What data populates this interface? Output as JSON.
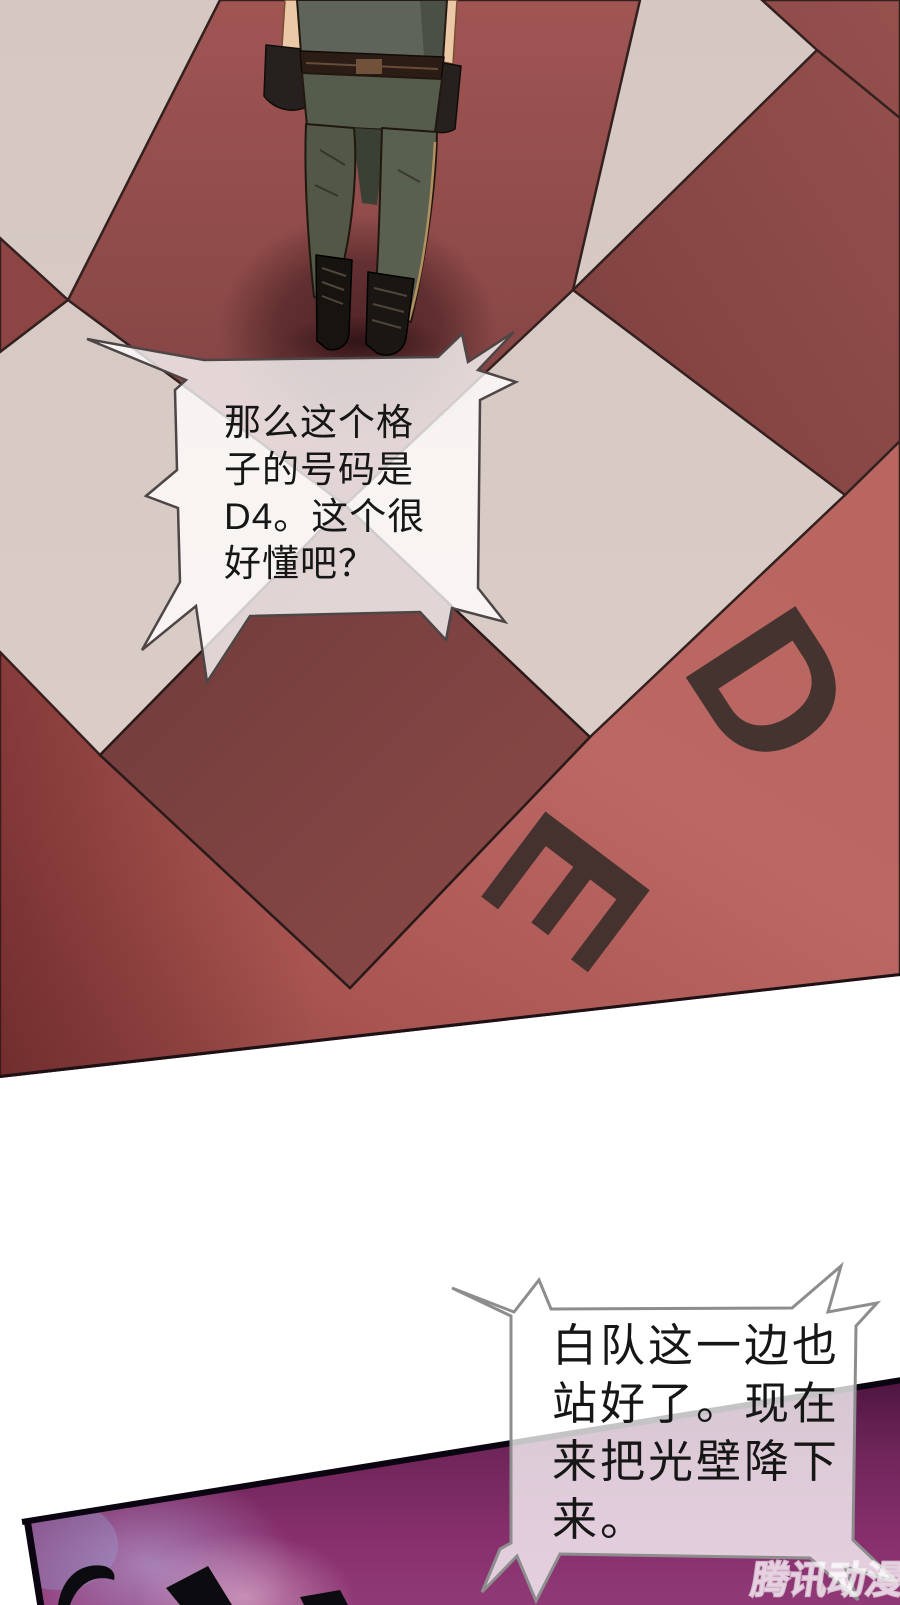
{
  "panel": {
    "type": "manhua-comic-page"
  },
  "bubbles": {
    "top": {
      "lines": [
        "那么这个格",
        "子的号码是",
        "D4。这个很",
        "好懂吧？"
      ]
    },
    "bottom": {
      "lines": [
        "白队这一边也",
        "站好了。现在",
        "来把光壁降下",
        "来。"
      ]
    }
  },
  "floor_labels": {
    "d": "D",
    "e": "E"
  },
  "watermark": {
    "text": "腾讯动漫"
  },
  "colors": {
    "cream": "#d8cbc5",
    "salmon": "#b96560",
    "tile-red": "#96504d",
    "maroon": "#744040",
    "outline": "#33201f",
    "purple": "#872f6d",
    "purple-dark": "#4e1540",
    "letter": "#3c2f2c",
    "ink": "#161616",
    "bubble-stroke-top": "#4e4646",
    "bubble-stroke-bottom": "#8d8d8d"
  }
}
